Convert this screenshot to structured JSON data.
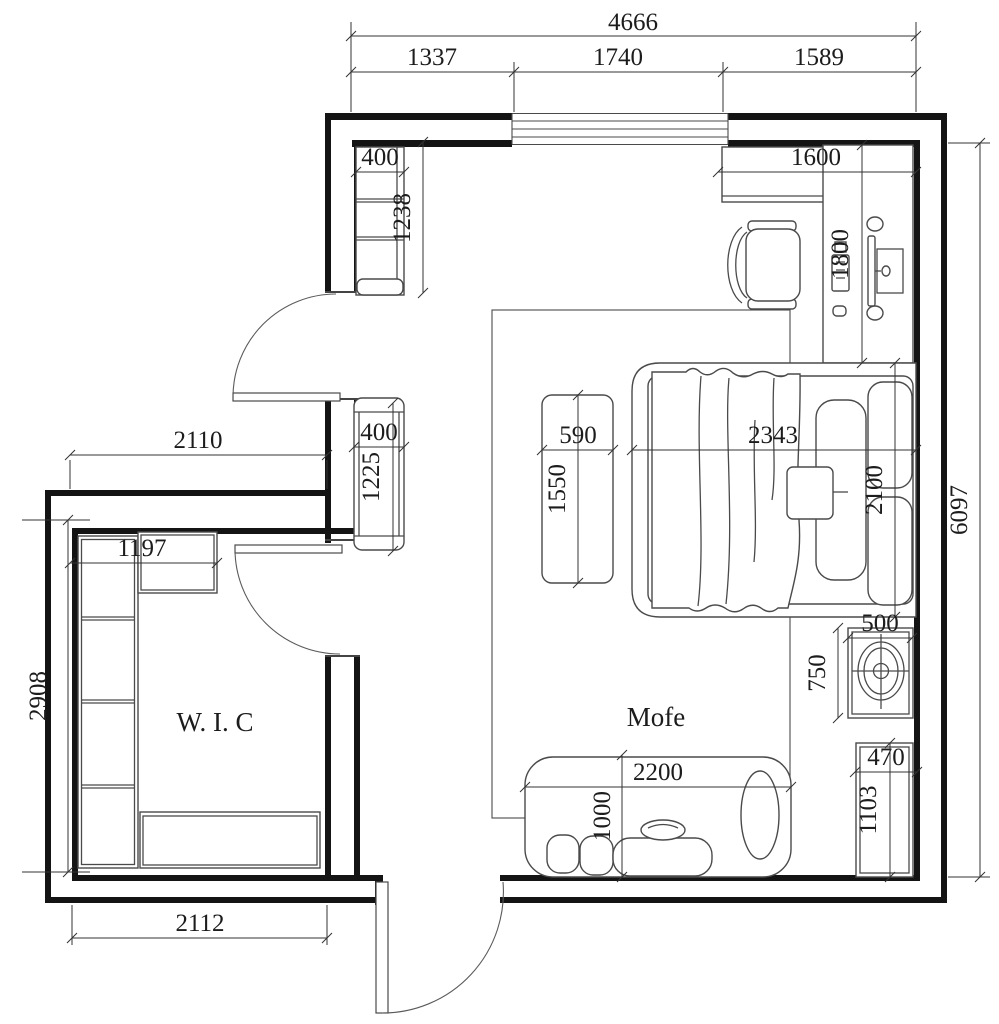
{
  "labels": {
    "wic": "W. I. C",
    "sofa_area": "Mofe"
  },
  "dims": {
    "total_width": "4666",
    "seg_left": "1337",
    "seg_window": "1740",
    "seg_right": "1589",
    "shelf_unit_w": "400",
    "shelf_unit_h": "1238",
    "desk_wall_w": "1600",
    "desk_l": "1800",
    "hall_w": "2110",
    "cab2_w": "400",
    "cab2_h": "1225",
    "bench_w": "590",
    "bench_h": "1550",
    "bed_l": "2343",
    "bed_w": "2100",
    "room_h": "6097",
    "wic_cab_w": "1197",
    "wic_h": "2908",
    "sink_w": "500",
    "sink_d": "750",
    "cab3_w": "470",
    "cab3_h": "1103",
    "sofa_l": "2200",
    "sofa_d": "1000",
    "wic_w": "2112"
  }
}
